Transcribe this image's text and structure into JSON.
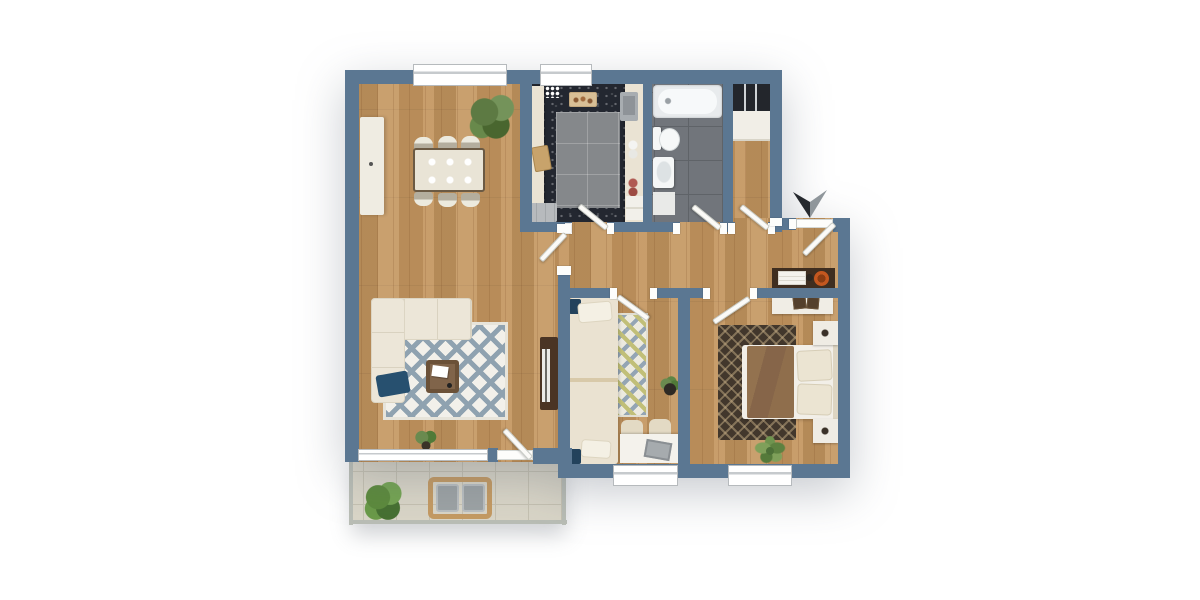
{
  "meta": {
    "description": "3D top-down rendered apartment floor plan on white background",
    "canvas": {
      "width": 1200,
      "height": 600
    }
  },
  "palette": {
    "page_bg": "#ffffff",
    "wall": "#5b7792",
    "wood": "#c2945e",
    "door": "#fbfaf7",
    "kitchen_tile": "#232730",
    "kitchen_mat": "#85888b",
    "bath_tile": "#71757b",
    "bath_grout": "#5f6368",
    "balcony_tile": "#d9d5c7",
    "balcony_grout": "#c5c1b1",
    "white_furniture": "#efece2",
    "cream_counter": "#eae3d3",
    "sofa_cream": "#ece6d8",
    "rug_living_accent": "#8fa2b0",
    "rug_runner_yellow": "#c1bf78",
    "rug_runner_blue": "#94a5b4",
    "rug_master_bg": "#42372c",
    "rug_master_line": "#c4ac84",
    "duvet_brown": "#8a6a4d",
    "navy_cushion": "#27506f",
    "walnut_dark": "#4a3424",
    "console_dark": "#3f2e20",
    "bowl_orange": "#c4571f",
    "plant_green": "#6f944f",
    "plant_dark": "#4d7038",
    "laptop_gray": "#a6abae",
    "appliance_gray": "#b7babd",
    "arrow_dark": "#26292e",
    "arrow_light": "#8f969b"
  },
  "scene": {
    "type": "apartment-floor-plan-3d-top-view",
    "compass": "dark two-tone arrow outside top-right, pointing down",
    "rooms": [
      {
        "name": "living-dining-room",
        "furniture": [
          "corner-sofa",
          "navy-cushion",
          "diamond-pattern-rug",
          "coffee-table",
          "tv-sideboard",
          "dining-table",
          "six-dining-chairs",
          "tall-sideboard",
          "large-plant",
          "small-plant",
          "balcony-door",
          "wide-window"
        ]
      },
      {
        "name": "kitchen",
        "furniture": [
          "left-counter",
          "top-counter-with-hob",
          "right-counter-with-sink",
          "gray-floor-mat",
          "cutting-board",
          "dishwasher",
          "window"
        ]
      },
      {
        "name": "bathroom",
        "furniture": [
          "bathtub",
          "toilet",
          "washbasin",
          "bath-mat"
        ]
      },
      {
        "name": "hallway",
        "furniture": [
          "console-table",
          "orange-bowl",
          "wardrobe-dark",
          "white-cabinet",
          "entry-door"
        ]
      },
      {
        "name": "bedroom",
        "furniture": [
          "single-bed",
          "runner-rug",
          "desk",
          "two-chairs",
          "laptop",
          "potted-plant",
          "window"
        ]
      },
      {
        "name": "master-bedroom",
        "furniture": [
          "double-bed-brown-duvet",
          "two-nightstands",
          "dresser",
          "dark-pattern-rug",
          "palm-plant",
          "window"
        ]
      },
      {
        "name": "balcony",
        "furniture": [
          "wooden-patio-table",
          "two-gray-chairs",
          "green-bush",
          "tiled-floor",
          "railing"
        ]
      }
    ],
    "door_count": 8,
    "window_count": 5
  }
}
